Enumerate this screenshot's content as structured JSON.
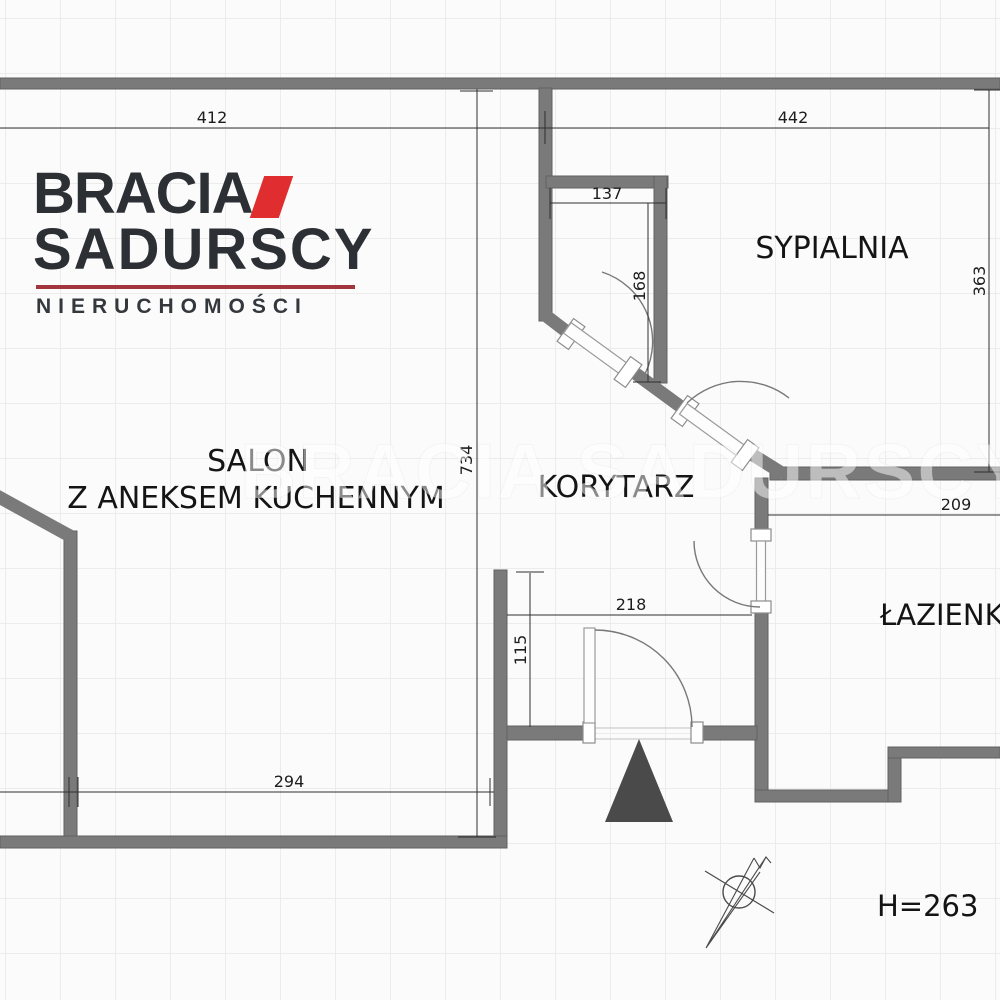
{
  "brand": {
    "name_line1": "BRACIA",
    "name_line2": "SADURSCY",
    "tagline": "NIERUCHOMOŚCI",
    "accent_red": "#e02d30",
    "rule_red": "#a3353c"
  },
  "watermark": "BRACIA SADURSCY",
  "rooms": {
    "salon_line1": "SALON",
    "salon_line2": "Z ANEKSEM KUCHENNYM",
    "bedroom": "SYPIALNIA",
    "corridor": "KORYTARZ",
    "bathroom": "ŁAZIENKA"
  },
  "dimensions": {
    "salon_top_width": "412",
    "bedroom_top_width": "442",
    "closet_width": "137",
    "closet_depth": "168",
    "bedroom_depth": "363",
    "plan_depth": "734",
    "bathroom_top_width": "209",
    "hall_width": "218",
    "hall_depth": "115",
    "salon_bottom_width": "294"
  },
  "ceiling_height_label": "H=263",
  "icons": {
    "compass": "north-arrow",
    "entrance_marker": "triangle-up"
  },
  "colors": {
    "wall_gray": "#7a7a7a",
    "marker_gray": "#4a4a4a"
  }
}
